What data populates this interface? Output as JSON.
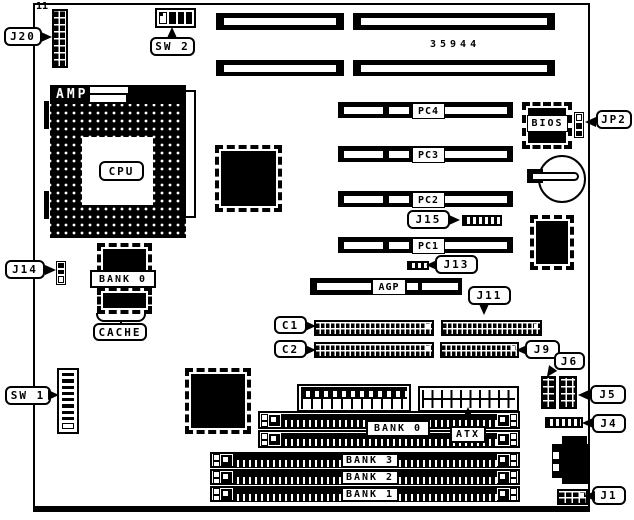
{
  "board": {
    "part_number": "35944",
    "pin1_marker": "11"
  },
  "cpu_socket": {
    "brand": "AMP",
    "label": "CPU"
  },
  "cache": {
    "bank": "BANK 0",
    "label": "CACHE"
  },
  "bios": {
    "label": "BIOS"
  },
  "slots": {
    "pc1": "PC1",
    "pc2": "PC2",
    "pc3": "PC3",
    "pc4": "PC4",
    "agp": "AGP"
  },
  "memory": {
    "bank0": "BANK 0",
    "bank1": "BANK 1",
    "bank2": "BANK 2",
    "bank3": "BANK 3"
  },
  "power": {
    "atx": "ATX"
  },
  "connectors": {
    "j1": "J1",
    "j4": "J4",
    "j5": "J5",
    "j6": "J6",
    "j9": "J9",
    "j11": "J11",
    "j13": "J13",
    "j14": "J14",
    "j15": "J15",
    "j20": "J20",
    "jp2": "JP2",
    "c1": "C1",
    "c2": "C2"
  },
  "switches": {
    "sw1": "SW 1",
    "sw2": "SW 2"
  }
}
